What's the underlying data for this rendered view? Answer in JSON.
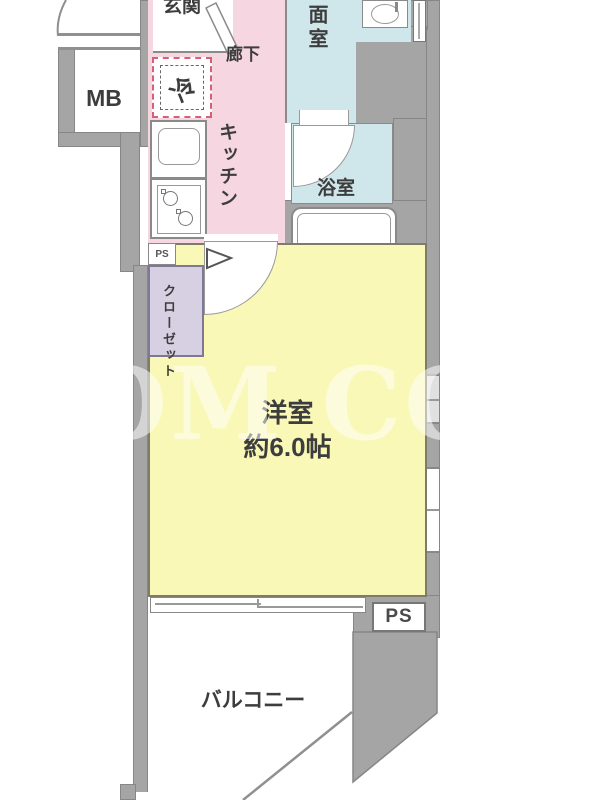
{
  "floorplan": {
    "labels": {
      "entrance": "玄関",
      "hallway": "廊下",
      "meter_box": "MB",
      "refrigerator": "冷",
      "kitchen": "キッチン",
      "washroom": "洗面室",
      "bathroom": "浴室",
      "closet": "クローゼット",
      "pipe_space_top": "PS",
      "pipe_space_bottom": "PS",
      "main_room_name": "洋室",
      "main_room_size": "約6.0帖",
      "balcony": "バルコニー"
    },
    "watermark": "OM CO",
    "colors": {
      "wall": "#a5a5a5",
      "kitchen_hallway": "#f6d7e1",
      "wet_area": "#cfe7eb",
      "main_room": "#f9f8b6",
      "closet": "#d7cfe2",
      "fridge_dash": "#d4607a",
      "outline": "#868686",
      "text": "#3d3d3d",
      "watermark_color": "#ffffff"
    }
  }
}
